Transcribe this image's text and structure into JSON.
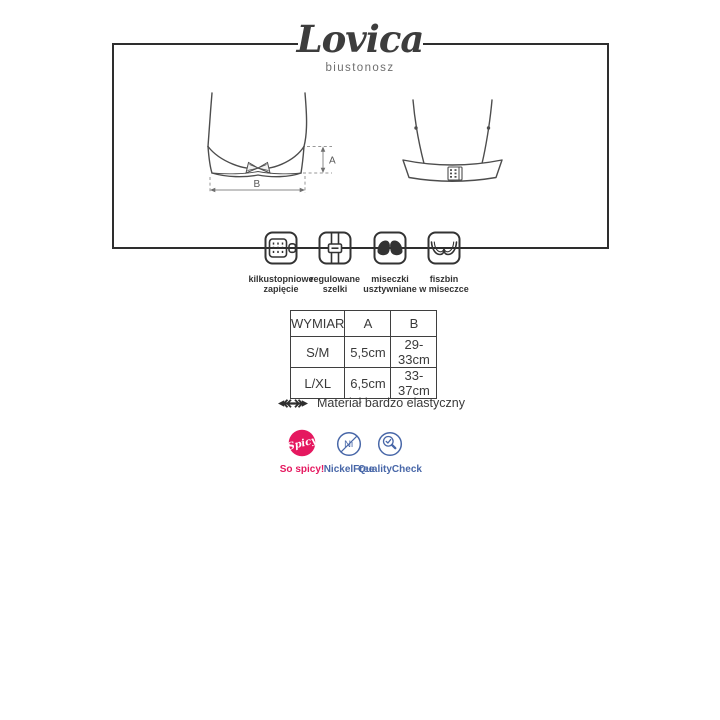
{
  "brand": {
    "name": "Lovica",
    "subtitle": "biustonosz"
  },
  "diagram": {
    "dim_a": "A",
    "dim_b": "B"
  },
  "features": [
    {
      "line1": "kilkustopniowe",
      "line2": "zapięcie"
    },
    {
      "line1": "regulowane",
      "line2": "szelki"
    },
    {
      "line1": "miseczki",
      "line2": "usztywniane"
    },
    {
      "line1": "fiszbin",
      "line2": "w miseczce"
    }
  ],
  "size_table": {
    "headers": [
      "WYMIAR",
      "A",
      "B"
    ],
    "rows": [
      [
        "S/M",
        "5,5cm",
        "29-33cm"
      ],
      [
        "L/XL",
        "6,5cm",
        "33-37cm"
      ]
    ]
  },
  "material_note": "Materiał bardzo elastyczny",
  "badges": {
    "spicy": {
      "circle_text": "Spicy",
      "label": "So spicy!",
      "color": "#e5185f"
    },
    "nickel_free": {
      "circle_text": "Ni",
      "label": "NickelFree",
      "color": "#4867a8"
    },
    "quality_check": {
      "label": "QualityCheck",
      "color": "#4867a8"
    }
  },
  "colors": {
    "accent_pink": "#e5185f",
    "accent_blue": "#4867a8",
    "diagram_line": "#4d4d4d",
    "frame": "#2e2e2e",
    "text": "#3a3a3a"
  }
}
